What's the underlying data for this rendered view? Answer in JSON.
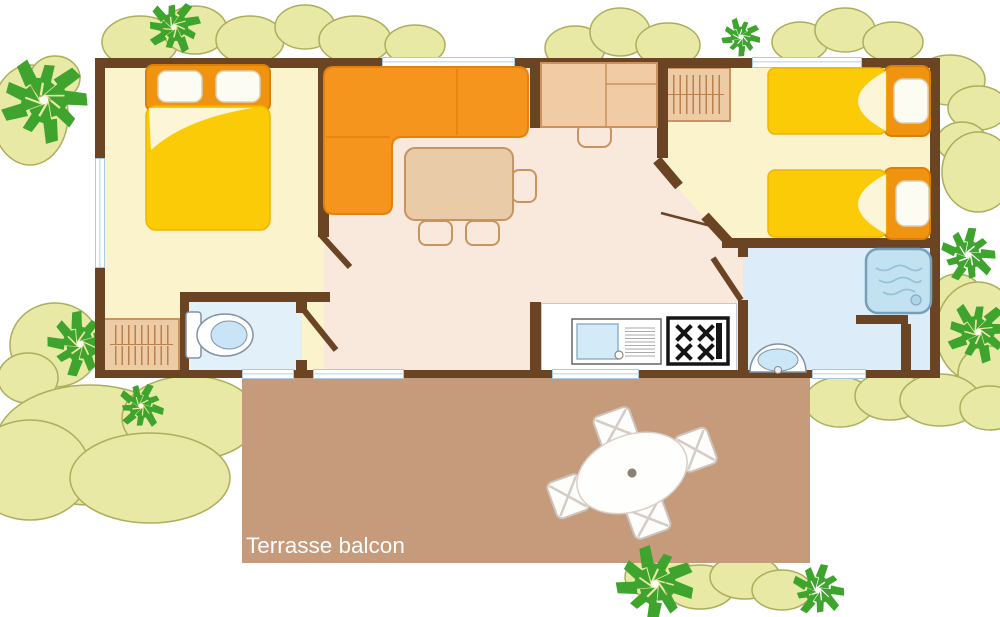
{
  "plan_title": "mobile-home floor plan",
  "terrace": {
    "label": "Terrasse balcon"
  },
  "rooms": [
    {
      "name": "bedroom-double",
      "furniture": [
        "double-bed",
        "wardrobe"
      ]
    },
    {
      "name": "wc",
      "furniture": [
        "toilet"
      ]
    },
    {
      "name": "living-dining",
      "furniture": [
        "corner-sofa",
        "dining-table",
        "three-chairs",
        "desk-with-chair"
      ]
    },
    {
      "name": "kitchen",
      "furniture": [
        "sink-with-drainer",
        "four-burner-hob"
      ]
    },
    {
      "name": "bedroom-twin",
      "furniture": [
        "single-bed",
        "single-bed",
        "wardrobe"
      ]
    },
    {
      "name": "bathroom",
      "furniture": [
        "shower",
        "washbasin"
      ]
    },
    {
      "name": "terrace",
      "furniture": [
        "oval-table",
        "four-chairs"
      ]
    }
  ],
  "palette": {
    "wall": "#6B4423",
    "floor_bedroom": "#FBF3CB",
    "floor_living": "#F9E8DC",
    "floor_wc": "#E2F0FA",
    "floor_bathroom": "#DCEDF9",
    "terrace": "#C59B7C",
    "sofa_orange": "#F6951D",
    "bed_blanket_yellow": "#FCCB08",
    "bed_headboard_orange": "#F0930F",
    "furniture_tan": "#EDCBA4",
    "window_glass": "#C9E2F2",
    "tree_green": "#3EA42D",
    "bush_fill": "#E7E9A5",
    "bush_outline": "#ABAF5D"
  }
}
